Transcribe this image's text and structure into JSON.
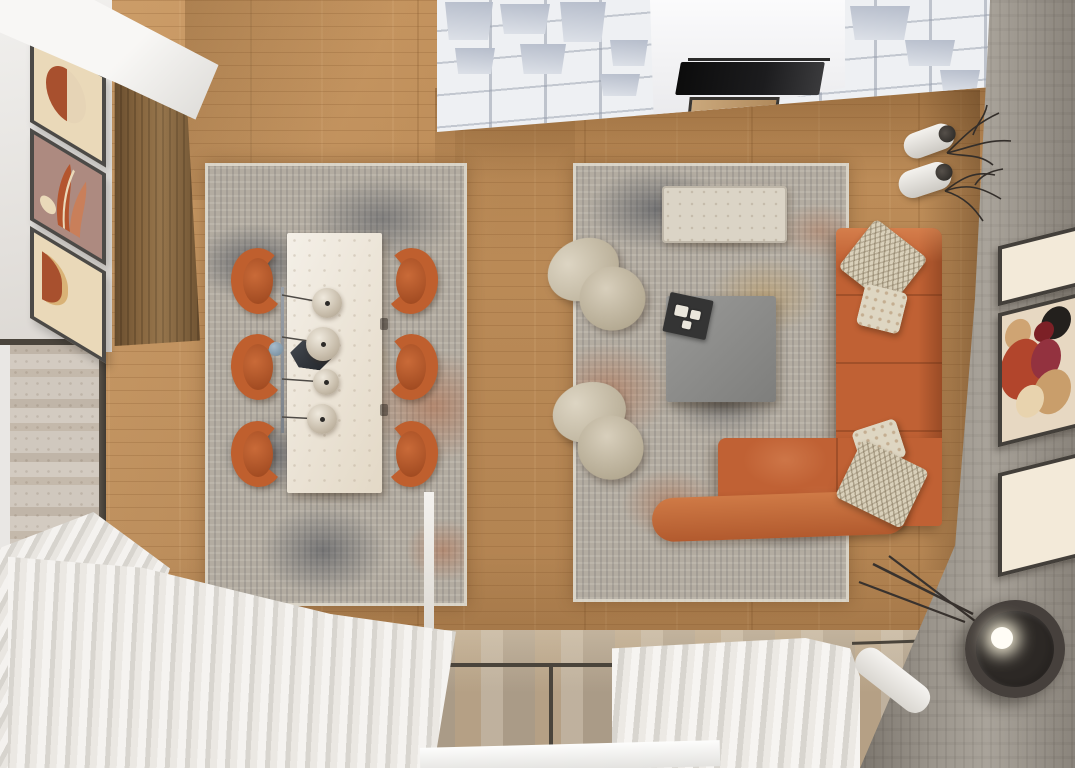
{
  "scene": {
    "type": "interior-render",
    "view": "top-down",
    "description": "Photorealistic top-down 3D render of an open-plan living and dining room: warm oak plank flooring, two distressed gray-and-rust area rugs, cream stone dining table with six terracotta chairs and four sphere pendant lights, terracotta L-shaped sectional sofa with patterned cream pillows, two cream boucle swivel armchairs, gray square coffee table with black tray, white grid shelving room divider with wall TV and fireplace, walnut cabinet, white wall with three terracotta abstract artworks, concrete accent wall with three framed artworks, white vases with dry branches, two black floor lamps, floor-to-ceiling glazing with white pleated sheer curtains."
  },
  "palette": {
    "wood": "#c99760",
    "rug_base": "#b3aca1",
    "rug_charcoal": "#3c424e",
    "rug_rust": "#b05a30",
    "rug_gold": "#c2913f",
    "terracotta": "#bf5f2e",
    "terracotta_dark": "#9c4a20",
    "sofa": "#c06134",
    "cream": "#e9e0d0",
    "boucle": "#cfc5b0",
    "white_wall": "#eceae7",
    "shelf_white": "#eef0f3",
    "concrete": "#9b958c",
    "glass": "#b3a694",
    "frame_dark": "#3f3b35",
    "curtain": "#edebe7",
    "cabinet": "#87663f",
    "table_gray": "#8d8d8b",
    "tray": "#343434",
    "art_cream": "#ead9b9",
    "art_rust": "#a8502e",
    "art_mauve": "#ad8a80",
    "art_tan": "#cfa06a"
  },
  "inventory": {
    "dining": {
      "rug": "Distressed gray-rust area rug",
      "table": "Cream stone rectangular dining table",
      "chair": "Terracotta dining chair",
      "chair_count": 6,
      "pendant": "Sphere pendant light on linear rail",
      "pendant_count": 4,
      "centerpiece": "Black hexagonal bowl"
    },
    "living": {
      "rug": "Distressed gray-rust area rug",
      "sofa": "Terracotta L-shaped sectional sofa",
      "pillow": "Patterned cream cushion",
      "pillow_count": 4,
      "armchair": "Cream boucle swivel armchair",
      "armchair_count": 2,
      "coffee_table": "Gray square coffee table",
      "tray": "Black serving tray with three white cups",
      "bench": "Cream stone bench"
    },
    "walls_and_decor": {
      "shelving": "White grid shelving room divider",
      "tv": "Wall-mounted TV seen from above",
      "fireplace": "Built-in fireplace with wood surround",
      "cabinet": "Tall walnut cabinet",
      "left_artwork": "Abstract terracotta art print",
      "left_artwork_count": 3,
      "right_artwork": "Framed abstract figure art",
      "right_artwork_count": 3,
      "vase": "White vase with dry branches",
      "vase_count": 2,
      "floor_lamp": "Black drum-shade floor lamp",
      "floor_lamp_count": 2
    },
    "window": {
      "curtain": "White pleated sheer curtain",
      "curtain_count": 3,
      "glazing": "Floor-to-ceiling window band"
    }
  }
}
